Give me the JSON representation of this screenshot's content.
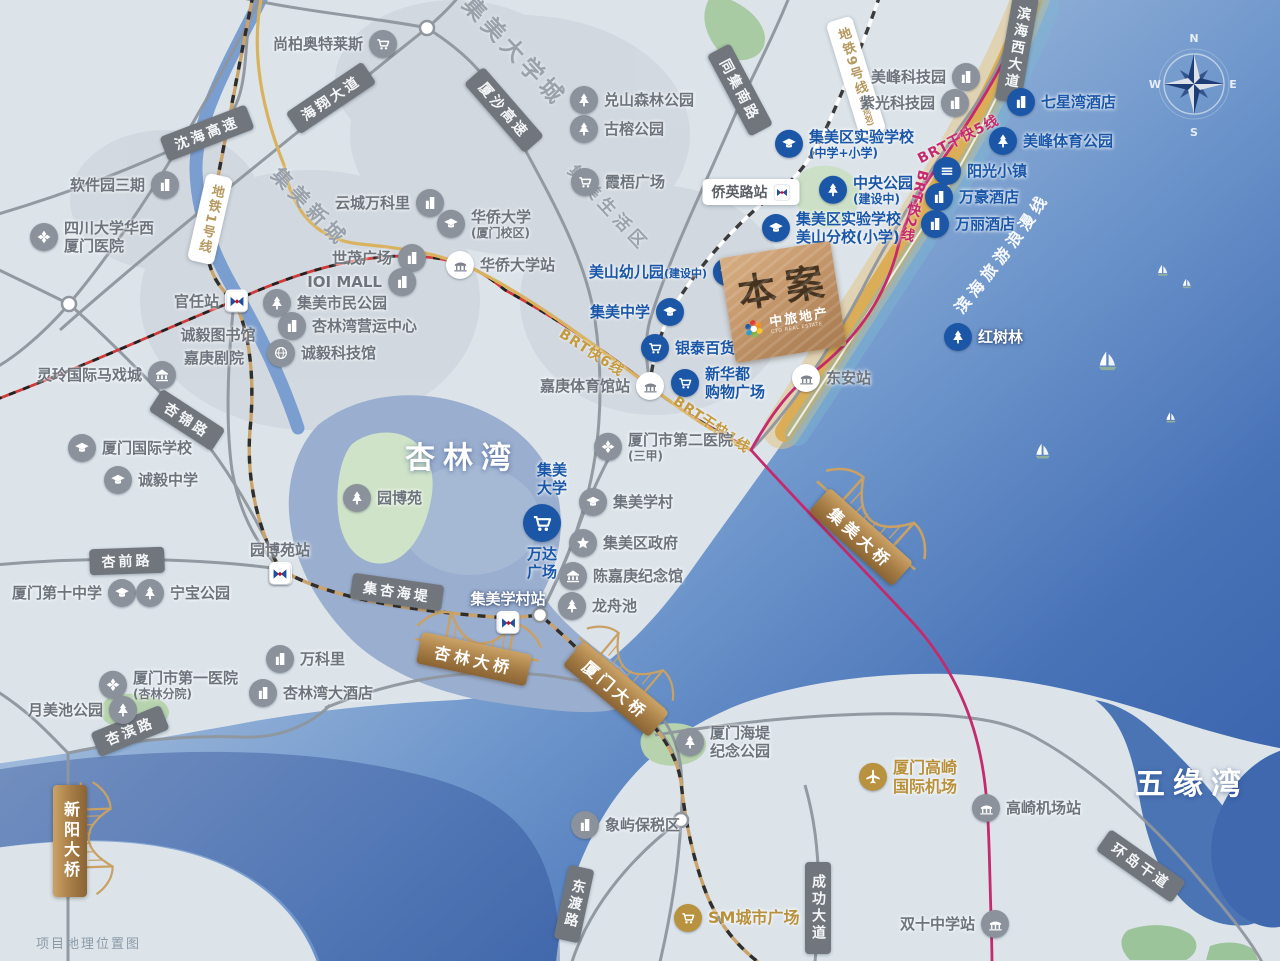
{
  "map_title": "项目地理位置图",
  "project_marker": {
    "label": "本案",
    "brand": "中旅地产",
    "brand_en": "CTG REAL ESTATE"
  },
  "compass": {
    "north": "N",
    "south": "S",
    "east": "E",
    "west": "W"
  },
  "colors": {
    "blue_label": "#1a57a8",
    "gray_label": "#6d747d",
    "gold_label": "#b8913c",
    "pink_line": "#c42a6d",
    "gold_line": "#d9b25f",
    "sea_deep": "#3a64ad",
    "copper": "#b2855a"
  },
  "coast_route_label": "滨海旅游浪漫线",
  "water_labels": [
    {
      "t": "杏林湾",
      "x": 462,
      "y": 455,
      "size": 30
    },
    {
      "t": "五缘湾",
      "x": 1192,
      "y": 781,
      "size": 30
    }
  ],
  "district_labels": [
    {
      "t": "集美大学城",
      "x": 516,
      "y": 50,
      "r": 47,
      "size": 23
    },
    {
      "t": "集美新城",
      "x": 311,
      "y": 206,
      "r": 46,
      "size": 20
    },
    {
      "t": "集美生活区",
      "x": 610,
      "y": 207,
      "r": 47,
      "size": 17
    }
  ],
  "road_signs": [
    {
      "t": "沈海高速",
      "x": 207,
      "y": 133,
      "r": -21
    },
    {
      "t": "海翔大道",
      "x": 331,
      "y": 98,
      "r": -34
    },
    {
      "t": "厦沙高速",
      "x": 504,
      "y": 110,
      "r": 49
    },
    {
      "t": "同集南路",
      "x": 740,
      "y": 90,
      "r": 62
    },
    {
      "t": "滨海西大道",
      "x": 1017,
      "y": 48,
      "r": 10,
      "v": 1
    },
    {
      "t": "杏锦路",
      "x": 187,
      "y": 420,
      "r": 33
    },
    {
      "t": "杏前路",
      "x": 127,
      "y": 561,
      "r": -2
    },
    {
      "t": "集杏海堤",
      "x": 397,
      "y": 592,
      "r": 8
    },
    {
      "t": "杏滨路",
      "x": 130,
      "y": 731,
      "r": -22
    },
    {
      "t": "东渡路",
      "x": 574,
      "y": 904,
      "r": 12,
      "v": 1
    },
    {
      "t": "成功大道",
      "x": 818,
      "y": 908,
      "r": 0,
      "v": 1
    },
    {
      "t": "环岛干道",
      "x": 1141,
      "y": 866,
      "r": 35
    }
  ],
  "metro_boxes": [
    {
      "t": "地铁1号线",
      "x": 210,
      "y": 219,
      "r": 13
    },
    {
      "t": "地铁9号线",
      "suf": "(已规划)",
      "x": 856,
      "y": 77,
      "r": -17
    }
  ],
  "brt_labels": [
    {
      "t": "BRT快6线",
      "x": 592,
      "y": 352,
      "r": 33,
      "c": "gold"
    },
    {
      "t": "BRT干快1线",
      "x": 712,
      "y": 424,
      "r": 34,
      "c": "gold"
    },
    {
      "t": "BRT干快5线",
      "x": 958,
      "y": 139,
      "r": -27,
      "c": "pink"
    },
    {
      "t": "BRT快2线",
      "x": 914,
      "y": 206,
      "r": 14,
      "c": "pink",
      "v": 1
    }
  ],
  "bridges": [
    {
      "t": "集美大桥",
      "x": 861,
      "y": 537,
      "r": 42,
      "gx": 878,
      "gy": 512,
      "gr": 42,
      "gs": 1
    },
    {
      "t": "杏林大桥",
      "x": 474,
      "y": 659,
      "r": 12,
      "gx": 480,
      "gy": 633,
      "gr": 10,
      "gs": 0.95
    },
    {
      "t": "厦门大桥",
      "x": 616,
      "y": 689,
      "r": 40,
      "gx": 632,
      "gy": 662,
      "gr": 40,
      "gs": 0.85
    },
    {
      "t": "新阳大桥",
      "x": 70,
      "y": 841,
      "r": 0,
      "v": 1,
      "gx": 98,
      "gy": 838,
      "gr": 88,
      "gs": 0.85
    }
  ],
  "pill_station": {
    "t": "侨英路站",
    "x": 751,
    "y": 192
  },
  "pois": [
    {
      "t": "尚柏奥特莱斯",
      "x": 383,
      "y": 44,
      "i": "cart",
      "s": "g",
      "side": "left"
    },
    {
      "t": "软件园三期",
      "x": 165,
      "y": 185,
      "i": "bld",
      "s": "g",
      "side": "left"
    },
    {
      "t": "四川大学华西",
      "t2": "厦门医院",
      "x": 44,
      "y": 237,
      "i": "hosp",
      "s": "g",
      "side": "right"
    },
    {
      "t": "官任站",
      "x": 234,
      "y": 301,
      "i": "metro",
      "s": "g",
      "side": "left"
    },
    {
      "t": "诚毅图书馆",
      "x": 218,
      "y": 335,
      "i": "none",
      "s": "g",
      "side": "center"
    },
    {
      "t": "嘉庚剧院",
      "x": 214,
      "y": 358,
      "i": "none",
      "s": "g",
      "side": "center"
    },
    {
      "t": "灵玲国际马戏城",
      "x": 162,
      "y": 375,
      "i": "museum",
      "s": "g",
      "side": "left"
    },
    {
      "t": "集美市民公园",
      "x": 277,
      "y": 303,
      "i": "tree",
      "s": "g",
      "side": "right"
    },
    {
      "t": "杏林湾营运中心",
      "x": 292,
      "y": 326,
      "i": "bld",
      "s": "g",
      "side": "right"
    },
    {
      "t": "诚毅科技馆",
      "x": 281,
      "y": 353,
      "i": "globe",
      "s": "g",
      "side": "right"
    },
    {
      "t": "世茂广场",
      "x": 412,
      "y": 258,
      "i": "bld",
      "s": "g",
      "side": "left"
    },
    {
      "t": "IOI MALL",
      "x": 402,
      "y": 282,
      "i": "bld",
      "s": "g",
      "side": "left"
    },
    {
      "t": "云城万科里",
      "x": 430,
      "y": 203,
      "i": "bld",
      "s": "g",
      "side": "left"
    },
    {
      "t": "华侨大学",
      "t2": "(厦门校区)",
      "x": 451,
      "y": 224,
      "i": "cap",
      "s": "g",
      "side": "right"
    },
    {
      "t": "霞梧广场",
      "x": 585,
      "y": 182,
      "i": "cart",
      "s": "g",
      "side": "right"
    },
    {
      "t": "兑山森林公园",
      "x": 584,
      "y": 100,
      "i": "tree",
      "s": "g",
      "side": "right"
    },
    {
      "t": "古榕公园",
      "x": 584,
      "y": 129,
      "i": "tree",
      "s": "g",
      "side": "right"
    },
    {
      "t": "美峰科技园",
      "x": 966,
      "y": 77,
      "i": "bld",
      "s": "g",
      "side": "left"
    },
    {
      "t": "紫光科技园",
      "x": 955,
      "y": 103,
      "i": "bld",
      "s": "g",
      "side": "left"
    },
    {
      "t": "厦门国际学校",
      "x": 82,
      "y": 448,
      "i": "cap",
      "s": "g",
      "side": "right"
    },
    {
      "t": "诚毅中学",
      "x": 118,
      "y": 480,
      "i": "cap",
      "s": "g",
      "side": "right"
    },
    {
      "t": "厦门第十中学",
      "x": 122,
      "y": 593,
      "i": "cap",
      "s": "g",
      "side": "left"
    },
    {
      "t": "宁宝公园",
      "x": 150,
      "y": 593,
      "i": "tree",
      "s": "g",
      "side": "right"
    },
    {
      "t": "园博苑",
      "x": 357,
      "y": 498,
      "i": "tree",
      "s": "g",
      "side": "right"
    },
    {
      "t": "园博苑站",
      "x": 280,
      "y": 569,
      "i": "metro",
      "s": "g",
      "side": "above"
    },
    {
      "t": "集美学村站",
      "x": 508,
      "y": 618,
      "i": "metro",
      "s": "g",
      "side": "above",
      "lc": "#fff"
    },
    {
      "t": "集美学村",
      "x": 593,
      "y": 502,
      "i": "cap",
      "s": "g",
      "side": "right"
    },
    {
      "t": "集美区政府",
      "x": 583,
      "y": 543,
      "i": "star",
      "s": "g",
      "side": "right"
    },
    {
      "t": "陈嘉庚纪念馆",
      "x": 573,
      "y": 576,
      "i": "museum",
      "s": "g",
      "side": "right"
    },
    {
      "t": "龙舟池",
      "x": 572,
      "y": 606,
      "i": "tree",
      "s": "g",
      "side": "right"
    },
    {
      "t": "厦门市第二医院",
      "t2": "(三甲)",
      "x": 608,
      "y": 447,
      "i": "hosp",
      "s": "g",
      "side": "right"
    },
    {
      "t": "嘉庚体育馆站",
      "x": 650,
      "y": 386,
      "i": "brt",
      "s": "g",
      "side": "left"
    },
    {
      "t": "东安站",
      "x": 806,
      "y": 378,
      "i": "brt",
      "s": "g",
      "side": "right"
    },
    {
      "t": "华侨大学站",
      "x": 460,
      "y": 265,
      "i": "brt",
      "s": "g",
      "side": "right"
    },
    {
      "t": "厦门市第一医院",
      "t2": "(杏林分院)",
      "x": 113,
      "y": 685,
      "i": "hosp",
      "s": "g",
      "side": "right"
    },
    {
      "t": "月美池公园",
      "x": 123,
      "y": 710,
      "i": "tree",
      "s": "g",
      "side": "left"
    },
    {
      "t": "万科里",
      "x": 280,
      "y": 659,
      "i": "bld",
      "s": "g",
      "side": "right"
    },
    {
      "t": "杏林湾大酒店",
      "x": 263,
      "y": 693,
      "i": "bld",
      "s": "g",
      "side": "right"
    },
    {
      "t": "象屿保税区",
      "x": 585,
      "y": 825,
      "i": "bld",
      "s": "g",
      "side": "right"
    },
    {
      "t": "厦门海堤",
      "t2": "纪念公园",
      "x": 690,
      "y": 742,
      "i": "tree",
      "s": "g",
      "side": "right"
    },
    {
      "t": "高崎机场站",
      "x": 986,
      "y": 808,
      "i": "brtg",
      "s": "g",
      "side": "right"
    },
    {
      "t": "双十中学站",
      "x": 995,
      "y": 924,
      "i": "brtg",
      "s": "g",
      "side": "left"
    },
    {
      "t": "集美区实验学校",
      "t2": "(中学+小学)",
      "x": 789,
      "y": 144,
      "i": "cap",
      "s": "b",
      "side": "right"
    },
    {
      "t": "中央公园",
      "t2": "(建设中)",
      "x": 833,
      "y": 190,
      "i": "tree",
      "s": "b",
      "side": "right"
    },
    {
      "t": "集美区实验学校",
      "t2": "美山分校(小学)",
      "x": 776,
      "y": 228,
      "i": "cap",
      "s": "b",
      "side": "right"
    },
    {
      "t": "美山幼儿园",
      "suf": "(建设中)",
      "x": 727,
      "y": 272,
      "i": "cap",
      "s": "b",
      "side": "left"
    },
    {
      "t": "集美中学",
      "x": 670,
      "y": 312,
      "i": "cap",
      "s": "b",
      "side": "left"
    },
    {
      "t": "银泰百货",
      "x": 655,
      "y": 348,
      "i": "cart",
      "s": "b",
      "side": "right"
    },
    {
      "t": "新华都",
      "t2": "购物广场",
      "x": 685,
      "y": 383,
      "i": "cart",
      "s": "b",
      "side": "right"
    },
    {
      "t": "万达",
      "t2": "广场",
      "x": 542,
      "y": 520,
      "i": "cartL",
      "s": "b",
      "side": "below"
    },
    {
      "t": "集美",
      "t2": "大学",
      "x": 552,
      "y": 479,
      "i": "none",
      "s": "b",
      "side": "center"
    },
    {
      "t": "七星湾酒店",
      "x": 1021,
      "y": 102,
      "i": "bld",
      "s": "b",
      "side": "right"
    },
    {
      "t": "美峰体育公园",
      "x": 1003,
      "y": 141,
      "i": "tree",
      "s": "b",
      "side": "right"
    },
    {
      "t": "阳光小镇",
      "x": 947,
      "y": 171,
      "i": "town",
      "s": "b",
      "side": "right"
    },
    {
      "t": "万豪酒店",
      "x": 939,
      "y": 197,
      "i": "bld",
      "s": "b",
      "side": "right"
    },
    {
      "t": "万丽酒店",
      "x": 935,
      "y": 224,
      "i": "bld",
      "s": "b",
      "side": "right"
    },
    {
      "t": "红树林",
      "x": 958,
      "y": 337,
      "i": "tree",
      "s": "b",
      "side": "right",
      "lc": "#fff"
    },
    {
      "t": "厦门高崎",
      "t2": "国际机场",
      "x": 873,
      "y": 777,
      "i": "plane",
      "s": "gd",
      "side": "right"
    },
    {
      "t": "SM城市广场",
      "x": 688,
      "y": 918,
      "i": "cart",
      "s": "gd",
      "side": "right"
    }
  ],
  "boats": [
    {
      "x": 1163,
      "y": 271,
      "s": 0.6
    },
    {
      "x": 1187,
      "y": 284,
      "s": 0.5
    },
    {
      "x": 1108,
      "y": 362,
      "s": 1.0
    },
    {
      "x": 1043,
      "y": 452,
      "s": 0.8
    },
    {
      "x": 1171,
      "y": 418,
      "s": 0.55
    }
  ]
}
